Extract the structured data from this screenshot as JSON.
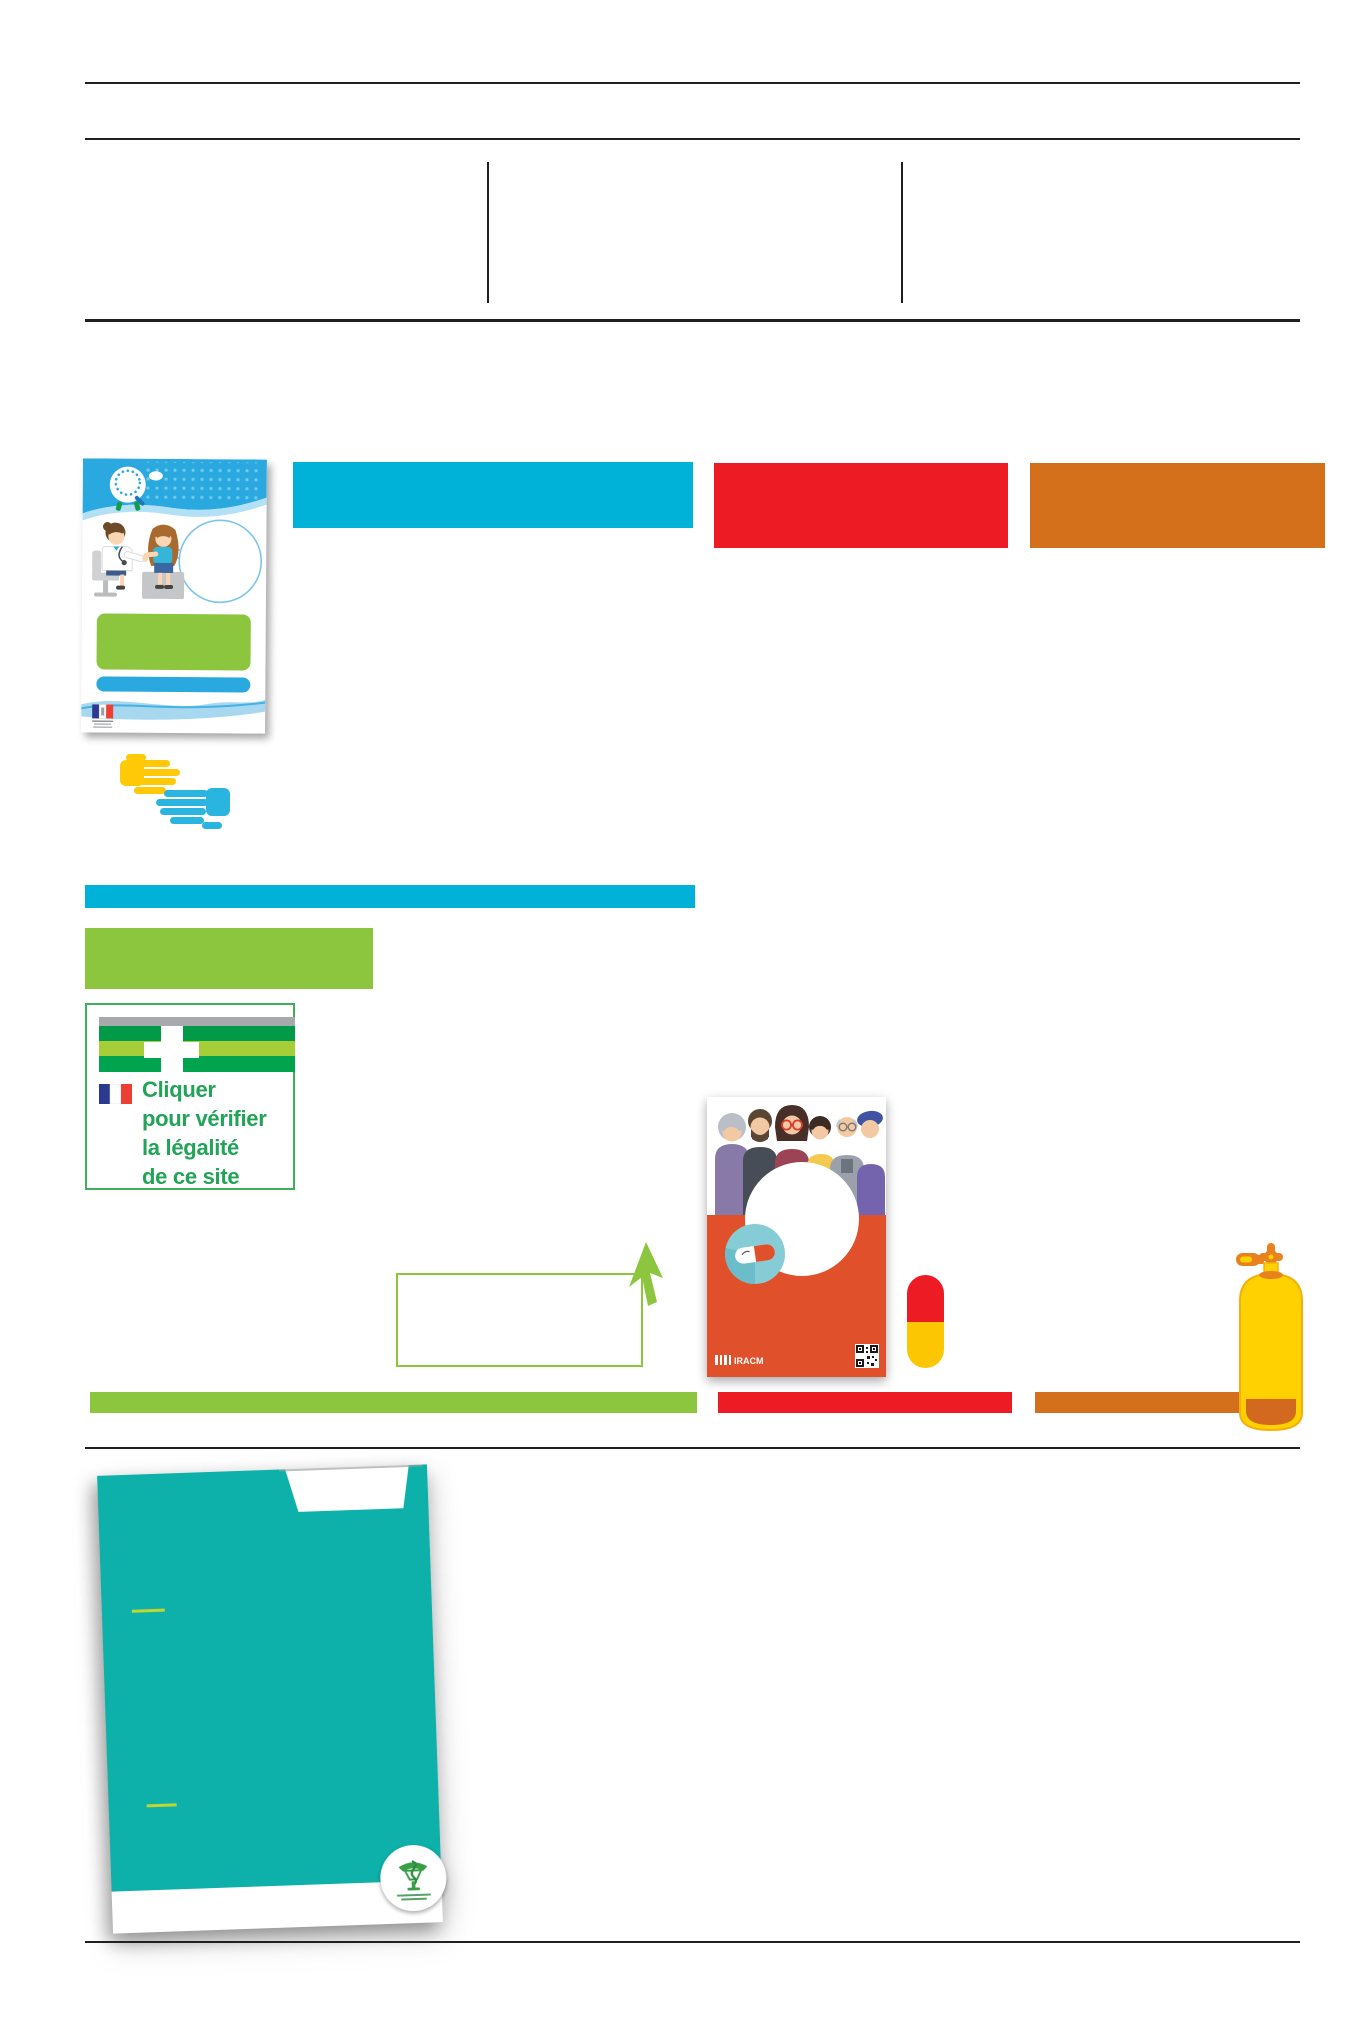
{
  "page": {
    "background": "#ffffff",
    "width": 1361,
    "height": 2041
  },
  "colors": {
    "rule": "#231f20",
    "cyan": "#00b1d8",
    "brochureBlue": "#2aa9e1",
    "red": "#ed1c24",
    "orange": "#d4701c",
    "green": "#8cc63f",
    "teal": "#0db1aa",
    "posterOrange": "#e0512b",
    "yellow": "#ffd100",
    "handYellow": "#ffc907",
    "handCyan": "#29b5e0",
    "capsuleRed": "#ed1c24",
    "capsuleYellow": "#fdc603",
    "textGreen": "#21a457",
    "flagBlue": "#2b3990",
    "flagRed": "#ef3e33",
    "badgeTeal": "#86ccd7",
    "caduceusGreen": "#3a9e49",
    "crossGray": "#a7a9ac",
    "crossDarkGreen": "#009a49",
    "crossLightGreen": "#a6ce39",
    "crossMidGreen": "#00a44f"
  },
  "verify_box": {
    "lines": [
      "Cliquer",
      "pour vérifier",
      "la légalité",
      "de ce site"
    ]
  },
  "poster": {
    "brand_label": "IRACM"
  },
  "icons": {
    "hands-icon": "two overlapping flat hands, yellow and cyan",
    "cursor-icon": "green mouse pointer arrow",
    "capsule-icon": "vertical capsule, red top / yellow bottom",
    "gas-cylinder-icon": "yellow medical gas cylinder with orange valve",
    "pharmacy-cross-icon": "EU common logo striped flag with white cross",
    "french-flag-icon": "French tricolour flag",
    "qr-code-icon": "QR code",
    "caduceus-icon": "green pharmacy caduceus in round badge",
    "rf-logo-icon": "French Republic tricolour logo block",
    "magnifier-logo-icon": "white circle campaign logo with magnifier",
    "speech-bubble": "large empty round speech bubble",
    "people-group": "six illustrated citizens",
    "doctor-patient": "doctor examining seated patient"
  }
}
